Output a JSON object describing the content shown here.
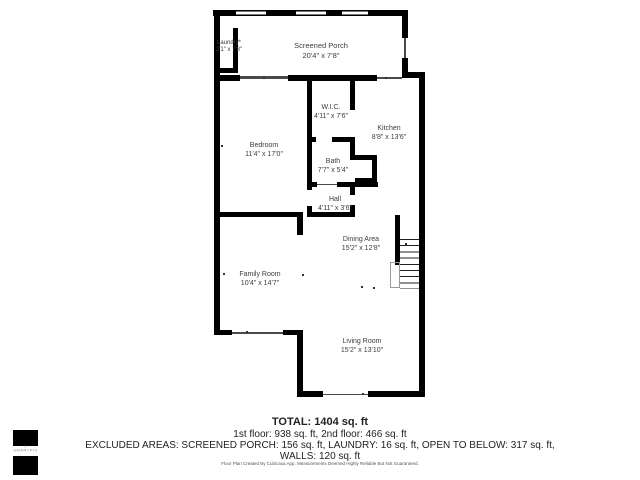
{
  "plan": {
    "rooms": [
      {
        "name": "Laundry*",
        "dims": "2'1\" x 7'8\""
      },
      {
        "name": "Screened Porch",
        "dims": "20'4\" x 7'8\""
      },
      {
        "name": "W.I.C.",
        "dims": "4'11\" x 7'6\""
      },
      {
        "name": "Kitchen",
        "dims": "8'8\" x 13'6\""
      },
      {
        "name": "Bedroom",
        "dims": "11'4\" x 17'0\""
      },
      {
        "name": "Bath",
        "dims": "7'7\" x 5'4\""
      },
      {
        "name": "Hall",
        "dims": "4'11\" x 3'6\""
      },
      {
        "name": "Dining Area",
        "dims": "15'2\" x 12'8\""
      },
      {
        "name": "Family Room",
        "dims": "10'4\" x 14'7\""
      },
      {
        "name": "Living Room",
        "dims": "15'2\" x 13'10\""
      }
    ]
  },
  "summary": {
    "total": "TOTAL: 1404 sq. ft",
    "floors": "1st floor: 938 sq. ft, 2nd floor: 466 sq. ft",
    "excluded_line1": "EXCLUDED AREAS: SCREENED PORCH: 156 sq. ft, LAUNDRY: 16 sq. ft, OPEN TO BELOW: 317 sq. ft,",
    "excluded_line2": "WALLS: 120 sq. ft"
  },
  "footer": {
    "disclaimer": "Floor Plan Created By Cubicasa App. Measurements Deemed Highly Reliable But Not Guaranteed."
  },
  "logo": {
    "text": "SMARTPIX",
    "icon": "house-icon"
  },
  "colors": {
    "wall": "#000000",
    "label": "#3d3d3d",
    "summary_text": "#222222",
    "disclaimer_text": "#555555"
  }
}
